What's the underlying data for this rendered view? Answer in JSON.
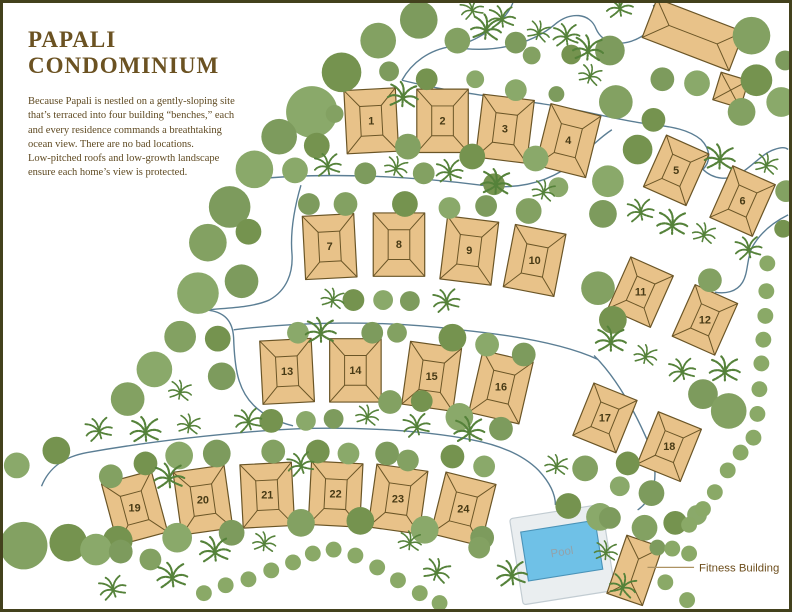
{
  "page": {
    "title_line1": "PAPALI",
    "title_line2": "CONDOMINIUM",
    "description_p1": "Because Papali is nestled on a gently-sloping site that’s terraced into four building “benches,” each and every residence commands a breathtaking ocean view. There are no bad locations.",
    "description_p2": "Low-pitched roofs and low-growth landscape ensure each home’s view is protected."
  },
  "map": {
    "units": [
      "1",
      "2",
      "3",
      "4",
      "5",
      "6",
      "7",
      "8",
      "9",
      "10",
      "11",
      "12",
      "13",
      "14",
      "15",
      "16",
      "17",
      "18",
      "19",
      "20",
      "21",
      "22",
      "23",
      "24"
    ],
    "pool_label": "Pool",
    "fitness_label": "Fitness Building"
  },
  "colors": {
    "building_fill": "#e8c289",
    "building_outline": "#6a5526",
    "unit_number": "#473a15",
    "tree_greens": [
      "#7d9b5d",
      "#83a162",
      "#75934f",
      "#8aa96a"
    ],
    "palm_green": "#55823a",
    "shrub_green": "#8aa967",
    "path_blue": "#5b7e94",
    "deck_fill": "#eaeef0",
    "deck_outline": "#c2ccd2",
    "water_fill": "#6fc1e7",
    "water_outline": "#4a93b8",
    "pool_label_color": "#93a2aa",
    "pointer_line": "#ad9262",
    "fitness_label_color": "#6d4e1d",
    "title_brown": "#6b5222",
    "body_brown": "#5f4a22",
    "frame_border": "#43411d"
  }
}
